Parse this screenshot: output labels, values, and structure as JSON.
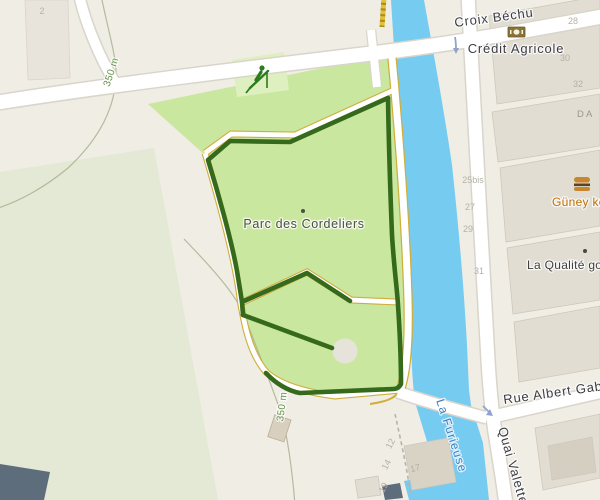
{
  "map": {
    "labels": {
      "street_top": "Croix Béchu",
      "street_bottom": "Rue Albert Gabe",
      "street_quai": "Quai Valette",
      "river": "La Furieuse",
      "park": "Parc des Cordeliers",
      "poi_bank": "Crédit Agricole",
      "poi_fast_food": "Güney ke",
      "poi_shop": "La Qualité gou",
      "road_ref": "D A",
      "contour_nw": "350 m",
      "contour_s": "350 m"
    },
    "house_numbers": {
      "hn2": "2",
      "hn28": "28",
      "hn30": "30",
      "hn32": "32",
      "hn25bis": "25bis",
      "hn27": "27",
      "hn29": "29",
      "hn31": "31",
      "hn12": "12",
      "hn14": "14",
      "hn17": "17",
      "hn19": "19"
    },
    "icons": [
      "bank-icon",
      "fast-food-icon",
      "playground-icon",
      "oneway-arrow-icon",
      "fountain"
    ],
    "colors": {
      "background": "#f0ede5",
      "park": "#cae7a0",
      "park_muted": "#e3e9d4",
      "playground": "#def0bf",
      "water": "#76cbf1",
      "water_label": "#3e7cc1",
      "route": "#35691b",
      "path_casing": "#cfae3c",
      "road_casing": "#d9d5cb",
      "building": "#e2ddd2",
      "poi_orange": "#c06f00",
      "contour": "#a9b290"
    }
  }
}
